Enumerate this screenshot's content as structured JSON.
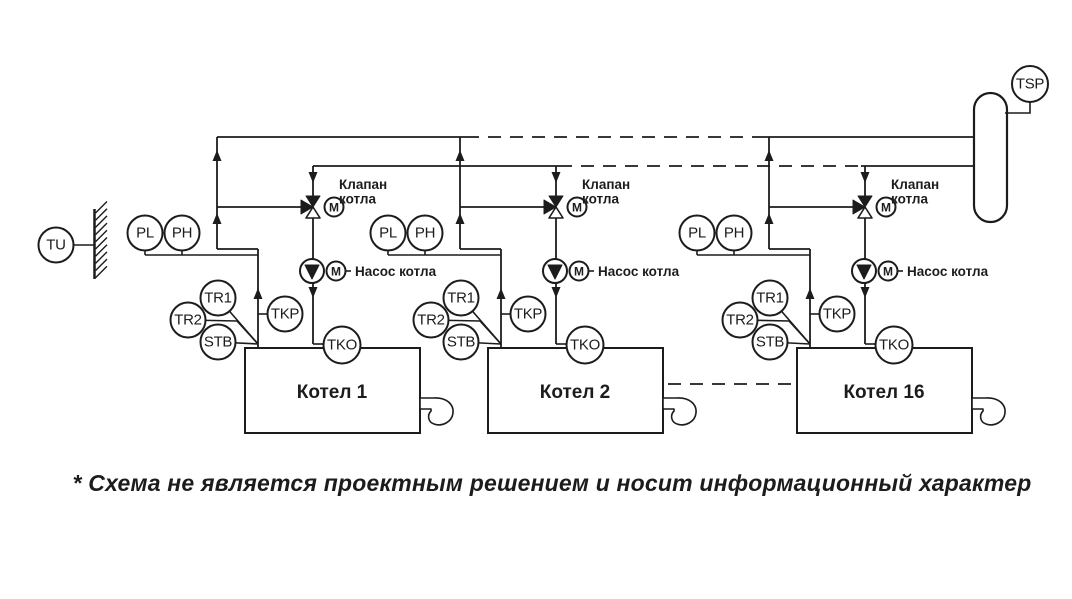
{
  "diagram": {
    "outdoor_sensor": {
      "label": "TU"
    },
    "collector_sensor": {
      "label": "TSP"
    },
    "units": [
      {
        "boiler_name": "Котел 1",
        "valve_label": [
          "Клапан",
          "котла"
        ],
        "valve_motor": "M",
        "pump_motor": "M",
        "pump_label": "Насос котла",
        "sensors": {
          "pl": "PL",
          "ph": "PH",
          "tr1": "TR1",
          "tr2": "TR2",
          "stb": "STB",
          "tkp": "TKP",
          "tko": "TKO"
        }
      },
      {
        "boiler_name": "Котел 2",
        "valve_label": [
          "Клапан",
          "котла"
        ],
        "valve_motor": "M",
        "pump_motor": "M",
        "pump_label": "Насос котла",
        "sensors": {
          "pl": "PL",
          "ph": "PH",
          "tr1": "TR1",
          "tr2": "TR2",
          "stb": "STB",
          "tkp": "TKP",
          "tko": "TKO"
        }
      },
      {
        "boiler_name": "Котел 16",
        "valve_label": [
          "Клапан",
          "котла"
        ],
        "valve_motor": "M",
        "pump_motor": "M",
        "pump_label": "Насос котла",
        "sensors": {
          "pl": "PL",
          "ph": "PH",
          "tr1": "TR1",
          "tr2": "TR2",
          "stb": "STB",
          "tkp": "TKP",
          "tko": "TKO"
        }
      }
    ],
    "footnote": "* Схема не является проектным решением и носит информационный характер",
    "colors": {
      "line": "#1c1c1c",
      "background": "#ffffff"
    }
  }
}
